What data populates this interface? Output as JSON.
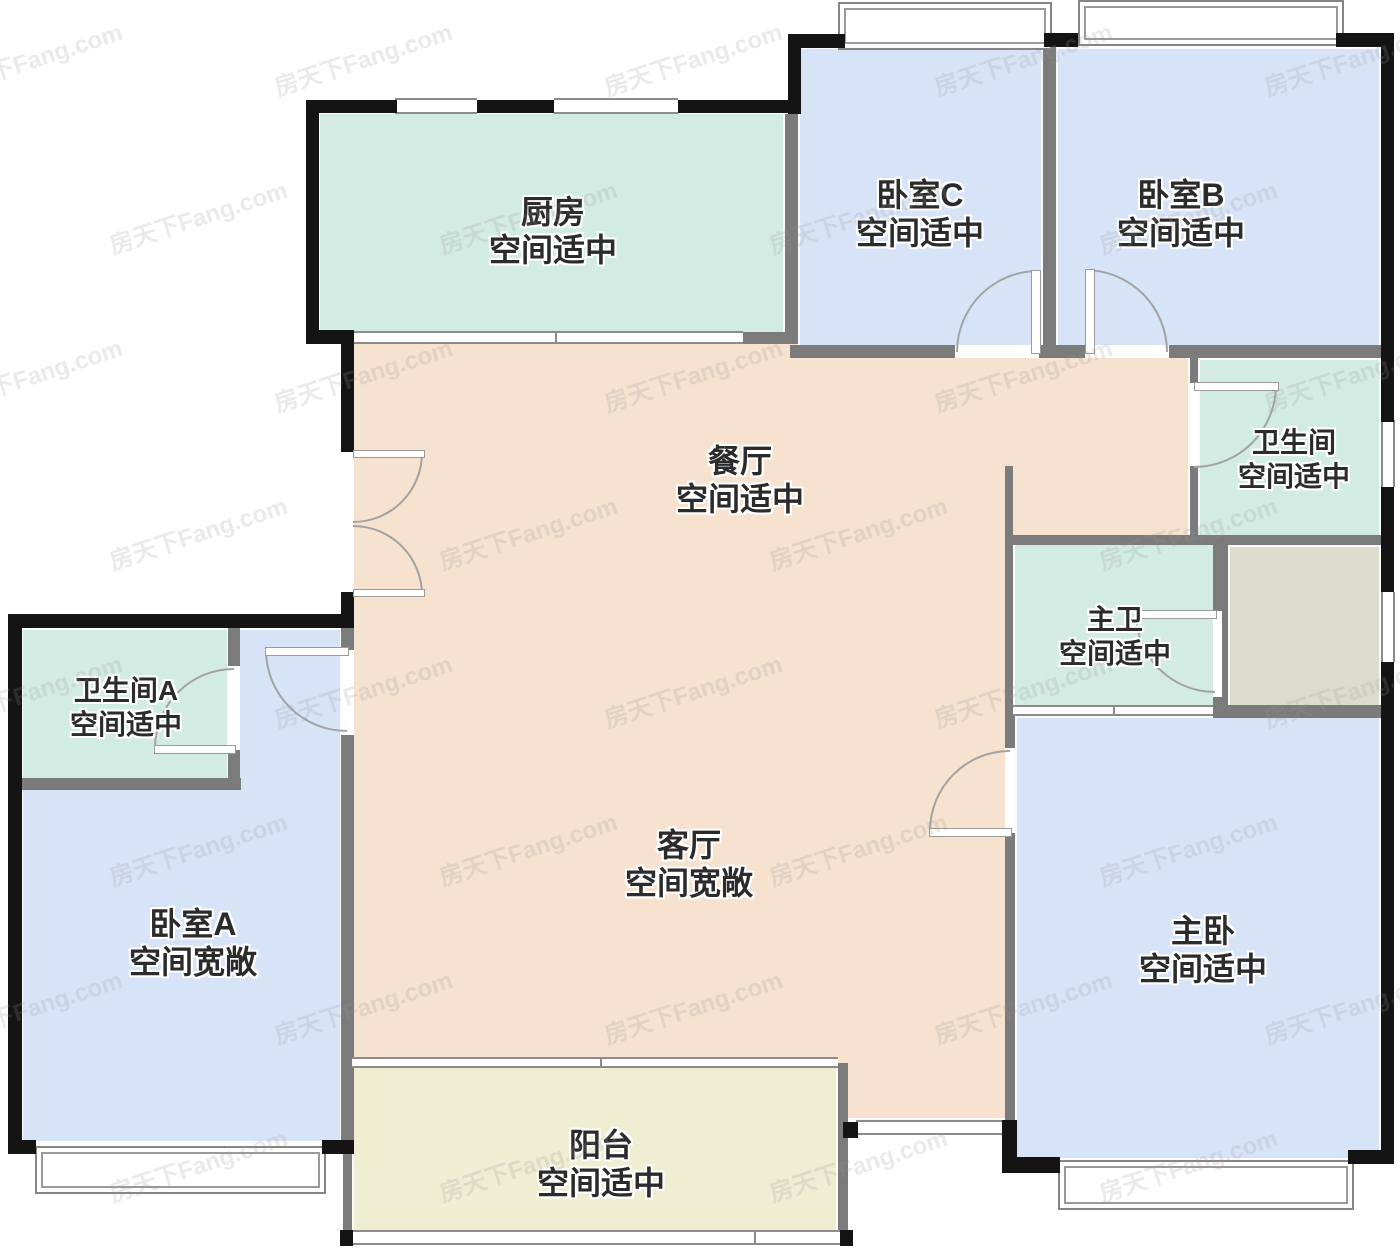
{
  "watermark": {
    "text": "房天下Fang.com"
  },
  "colors": {
    "room_teal": "#d3ece3",
    "room_blue": "#d7e4f8",
    "room_peach": "#f6e2cf",
    "room_cream": "#efedd2",
    "room_gray": "#dcdccd",
    "wall_black": "#141414",
    "wall_gray": "#7b7b7b",
    "label_text": "#2b2b2b"
  },
  "rooms": {
    "kitchen": {
      "name": "厨房",
      "note": "空间适中"
    },
    "bedroom_c": {
      "name": "卧室C",
      "note": "空间适中"
    },
    "bedroom_b": {
      "name": "卧室B",
      "note": "空间适中"
    },
    "bathroom": {
      "name": "卫生间",
      "note": "空间适中"
    },
    "master_bath": {
      "name": "主卫",
      "note": "空间适中"
    },
    "dining": {
      "name": "餐厅",
      "note": "空间适中"
    },
    "living": {
      "name": "客厅",
      "note": "空间宽敞"
    },
    "bathroom_a": {
      "name": "卫生间A",
      "note": "空间适中"
    },
    "bedroom_a": {
      "name": "卧室A",
      "note": "空间宽敞"
    },
    "master_bedroom": {
      "name": "主卧",
      "note": "空间适中"
    },
    "balcony": {
      "name": "阳台",
      "note": "空间适中"
    }
  }
}
